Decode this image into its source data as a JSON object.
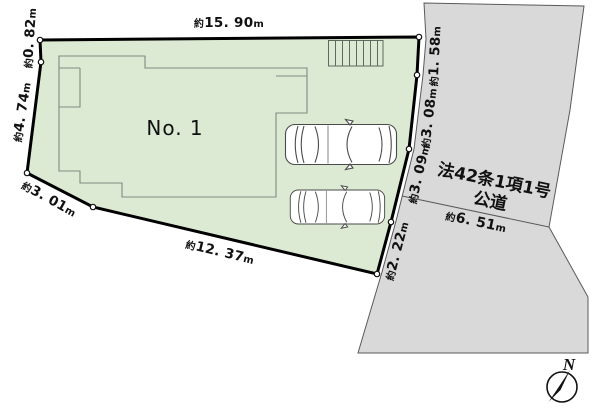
{
  "plot": {
    "number_label": "No. 1",
    "fill_color": "#dcead4",
    "dimensions": {
      "top": {
        "prefix": "約",
        "value": "15. 90",
        "unit": "m"
      },
      "upper_left": {
        "prefix": "約",
        "value": "0. 82",
        "unit": "m"
      },
      "left": {
        "prefix": "約",
        "value": "4. 74",
        "unit": "m"
      },
      "lower_left": {
        "prefix": "約",
        "value": "3. 01",
        "unit": "m"
      },
      "bottom": {
        "prefix": "約",
        "value": "12. 37",
        "unit": "m"
      },
      "right_bottom": {
        "prefix": "約",
        "value": "2. 22",
        "unit": "m"
      },
      "right_lower": {
        "prefix": "約",
        "value": "3. 09",
        "unit": "m"
      },
      "right_mid": {
        "prefix": "約",
        "value": "3. 08",
        "unit": "m"
      },
      "right_top": {
        "prefix": "約",
        "value": "1. 58",
        "unit": "m"
      }
    }
  },
  "road": {
    "fill_color": "#d9d9d9",
    "name_line1": "法42条1項1号",
    "name_line2": "公道",
    "width": {
      "prefix": "約",
      "value": "6. 51",
      "unit": "m"
    }
  },
  "compass": {
    "north_label": "N"
  }
}
